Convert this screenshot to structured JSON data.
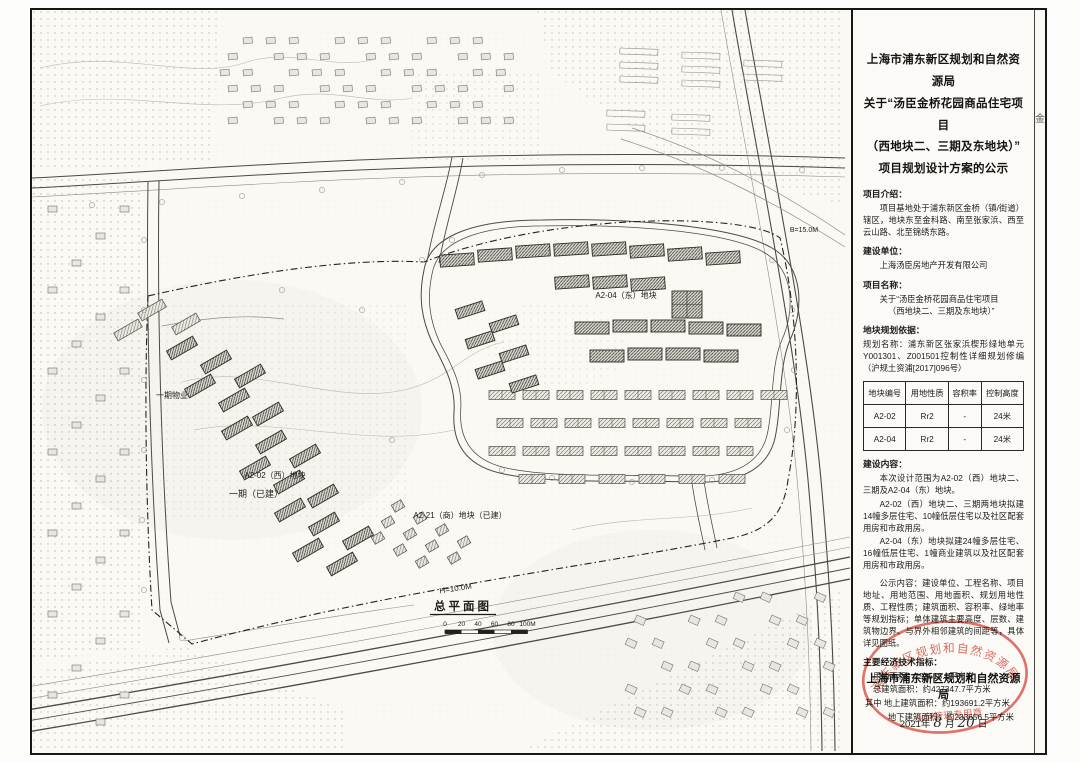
{
  "panel": {
    "title_lines": [
      "上海市浦东新区规划和自然资源局",
      "关于“汤臣金桥花园商品住宅项目",
      "（西地块二、三期及东地块）”",
      "项目规划设计方案的公示"
    ],
    "intro": {
      "label": "项目介绍：",
      "text": "项目基地处于浦东新区金桥（镇/街道）辖区，地块东至金科路、南至张家浜、西至云山路、北至锦绣东路。"
    },
    "builder": {
      "label": "建设单位：",
      "text": "上海汤臣房地产开发有限公司"
    },
    "project": {
      "label": "项目名称：",
      "line1": "关于“汤臣金桥花园商品住宅项目",
      "line2": "（西地块二、三期及东地块）”"
    },
    "basis": {
      "label": "地块规划依据：",
      "text": "规划名称：浦东新区张家浜楔形绿地单元Y001301、Z001501控制性详细规划修编（沪规土资浦[2017]096号）"
    },
    "table": {
      "headers": [
        "地块编号",
        "用地性质",
        "容积率",
        "控制高度"
      ],
      "rows": [
        [
          "A2-02",
          "Rr2",
          "-",
          "24米"
        ],
        [
          "A2-04",
          "Rr2",
          "-",
          "24米"
        ]
      ]
    },
    "content": {
      "label": "建设内容：",
      "p1": "本次设计范围为A2-02（西）地块二、三期及A2-04（东）地块。",
      "p2": "A2-02（西）地块二、三期两地块拟建14幢多层住宅、10幢低层住宅以及社区配套用房和市政用房。",
      "p3": "A2-04（东）地块拟建24幢多层住宅、16幢低层住宅、1幢商业建筑以及社区配套用房和市政用房。"
    },
    "notice": "公示内容：建设单位、工程名称、项目地址、用地范围、用地面积、规划用地性质、工程性质；建筑面积、容积率、绿地率等规划指标；单体建筑主要高度、层数、建筑物边界、与界外相邻建筑的间距等，具体详见图纸。",
    "indicators": {
      "label": "主要经济技术指标：",
      "rows": [
        "用地面积：253518.1平方米",
        "总建筑面积：约427347.7平方米",
        "其中 地上建筑面积：约193691.2平方米",
        "地下建筑面积：约233656.5平方米"
      ]
    },
    "footer": {
      "agency": "上海市浦东新区规划和自然资源局",
      "year": "2021年",
      "month": "8",
      "month_unit": "月",
      "day": "20",
      "day_unit": "日"
    },
    "stamp": {
      "arc_text": "浦东新区规划和自然资源局",
      "bottom_text": "业务管理专用章",
      "color": "#d94f44"
    }
  },
  "map": {
    "title": "总平面图",
    "scale_ticks": [
      "0",
      "20",
      "40",
      "60",
      "80",
      "100M"
    ],
    "labels": [
      {
        "t": "一期物业",
        "x": 140,
        "y": 388,
        "s": 8
      },
      {
        "t": "A2-02（西）地块",
        "x": 243,
        "y": 468,
        "s": 8
      },
      {
        "t": "一期（已建）",
        "x": 224,
        "y": 487,
        "s": 9
      },
      {
        "t": "A2-21（商）地块（已建）",
        "x": 428,
        "y": 508,
        "s": 8
      },
      {
        "t": "A2-04（东）地块",
        "x": 594,
        "y": 288,
        "s": 8
      },
      {
        "t": "H=10.0M",
        "x": 424,
        "y": 581,
        "s": 8,
        "r": -9
      },
      {
        "t": "B=15.0M",
        "x": 772,
        "y": 222,
        "s": 7
      }
    ]
  },
  "margin_note": "金"
}
